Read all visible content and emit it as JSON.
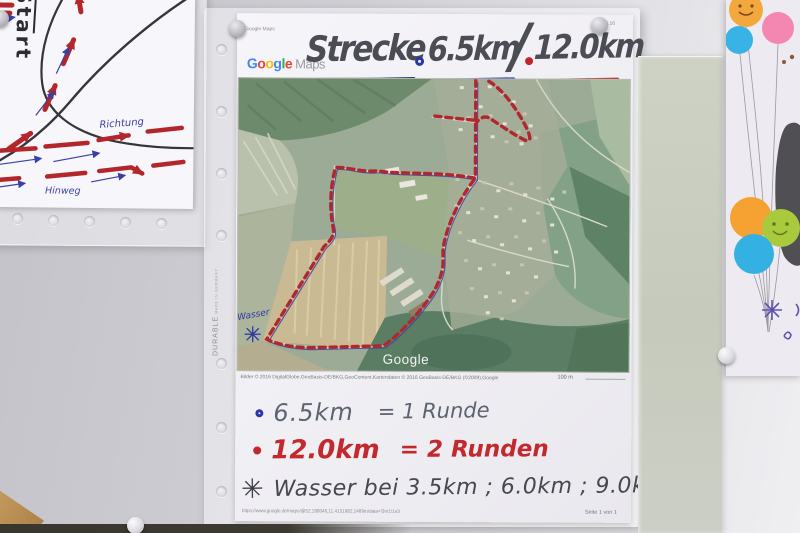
{
  "sketch": {
    "start": "Start",
    "richtung": "Richtung",
    "hinweg": "Hinweg"
  },
  "sleeve": {
    "brand": "DURABLE",
    "origin": "MADE IN GERMANY"
  },
  "main": {
    "print_header_left": "Google Maps",
    "print_header_right": "06.06.16",
    "logo_letters": [
      "G",
      "o",
      "o",
      "g",
      "l",
      "e"
    ],
    "logo_product": "Maps",
    "title": {
      "label": "Strecke",
      "short_distance": "6.5km",
      "separator": "/",
      "long_distance": "12.0km"
    },
    "map": {
      "watermark": "Google",
      "wasser_label": "Wasser",
      "attribution": "Bilder © 2016 DigitalGlobe,GeoBasis-DE/BKG,GeoContent,Kartendaten © 2016 GeoBasis-DE/BKG (©2009),Google",
      "scale_label": "100 m"
    },
    "notes": [
      {
        "bullet": "ring-blue",
        "distance": "6.5km",
        "equals": "= 1 Runde"
      },
      {
        "bullet": "dot-red",
        "distance": "12.0km",
        "equals": "= 2 Runden"
      },
      {
        "bullet": "✳",
        "text": "Wasser bei 3.5km ; 6.0km ; 9.0km"
      }
    ],
    "footer_url": "https://www.google.de/maps/@52.198046,11.4151982,1489m/data=!3m1!1e3",
    "footer_page": "Seite 1 von 1"
  },
  "colors": {
    "route_red": "#b2272f",
    "pen_blue": "#3a41a5",
    "note_red": "#c2282c",
    "ink_dark": "#46474f",
    "balloon_orange": "#f3a83d",
    "balloon_pink": "#f487b2",
    "balloon_blue": "#39b3e6",
    "balloon_green": "#a8ca3c"
  }
}
